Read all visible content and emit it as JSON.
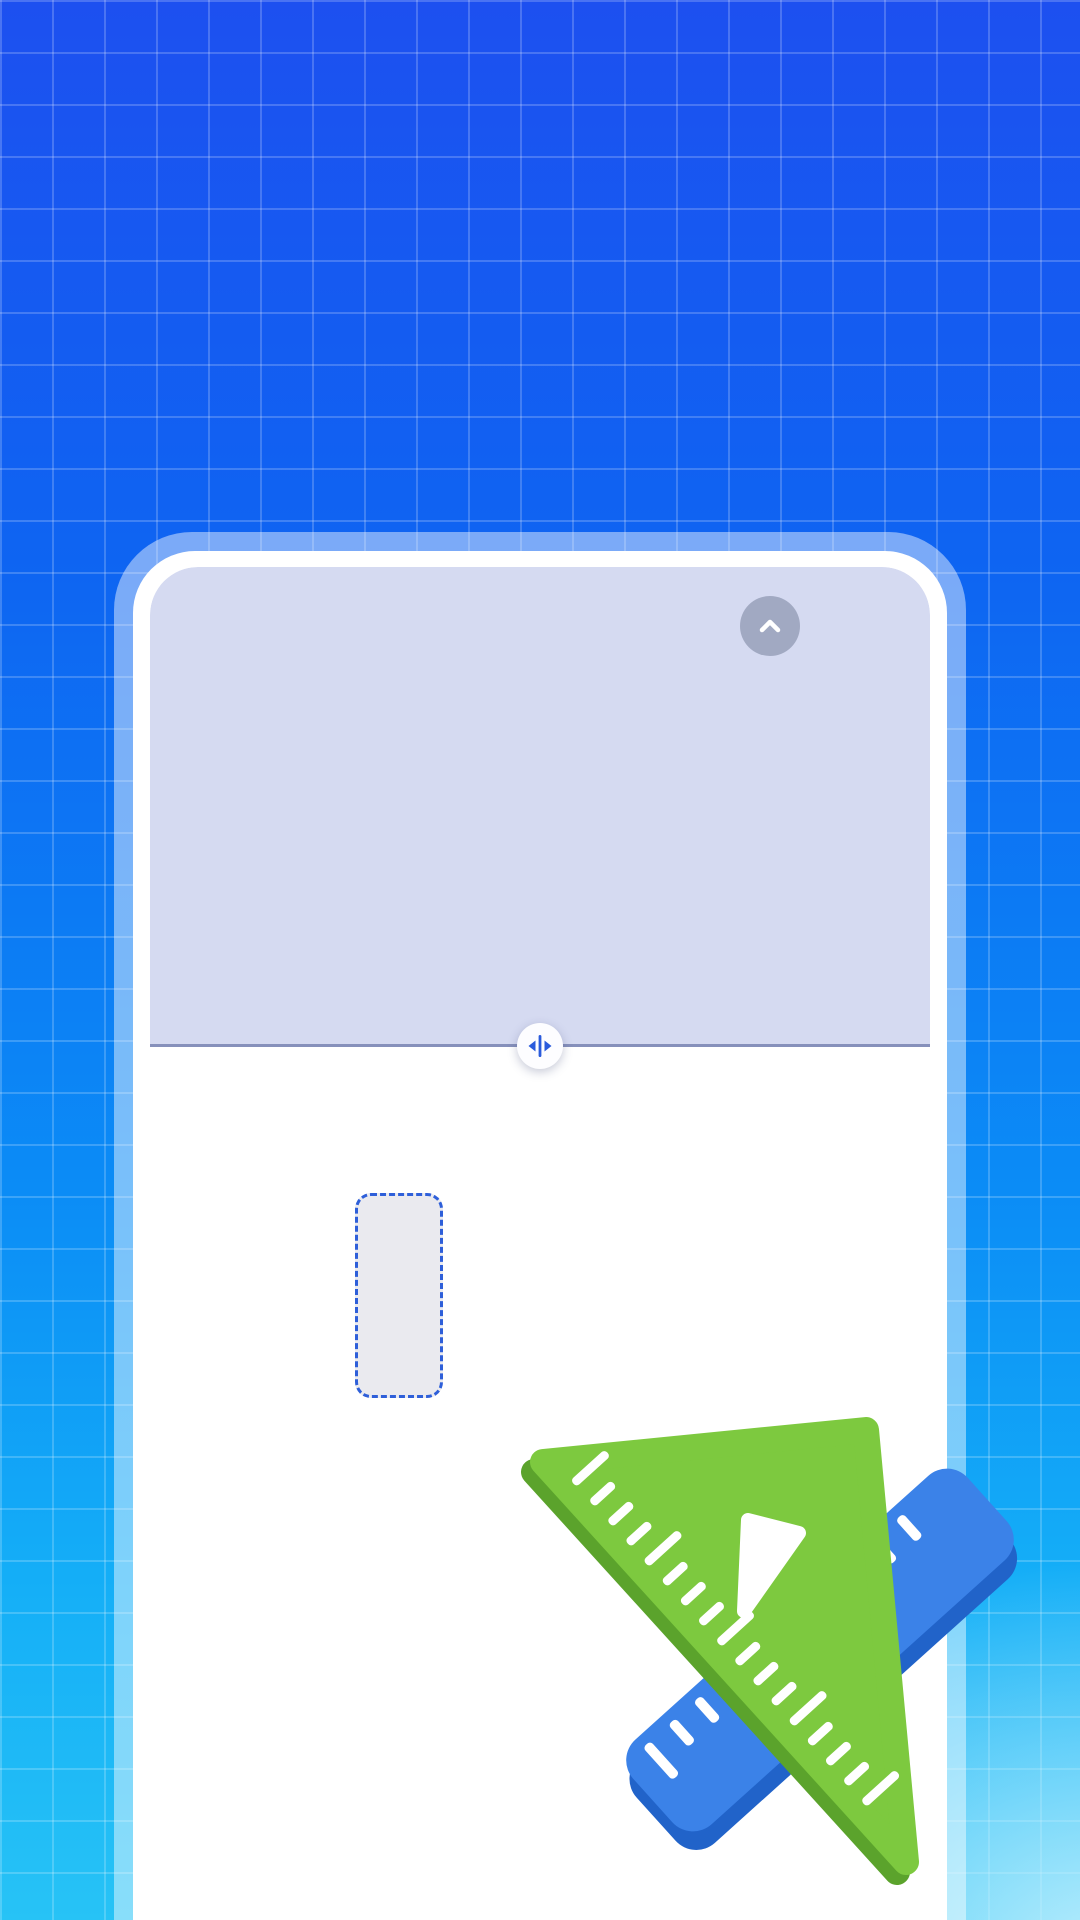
{
  "hero": {
    "title": "快捷直尺",
    "subtitle": "简单测量，高效灵活"
  },
  "ruler": {
    "unit_labels": [
      "0",
      "1",
      "2",
      "3",
      "4",
      "5",
      "6",
      "7",
      "8",
      "9",
      "10",
      "11",
      "12"
    ],
    "measurement_label": "4.4cm",
    "measured_value_cm": 4.4
  },
  "icons": {
    "collapse": "chevron-up-icon",
    "drag_handle": "move-horizontal-icon"
  },
  "colors": {
    "accent_blue": "#2e5fd9",
    "measured_fill": "#d5daf1",
    "divider": "#8690bb",
    "tick": "#3f4450",
    "bg_top": "#1d50f0",
    "bg_bottom": "#27c3f6",
    "triangle_green": "#7dc93f",
    "triangle_green_dark": "#5ba32c",
    "ruler_blue": "#3b82e8",
    "ruler_blue_dark": "#2163c9"
  }
}
